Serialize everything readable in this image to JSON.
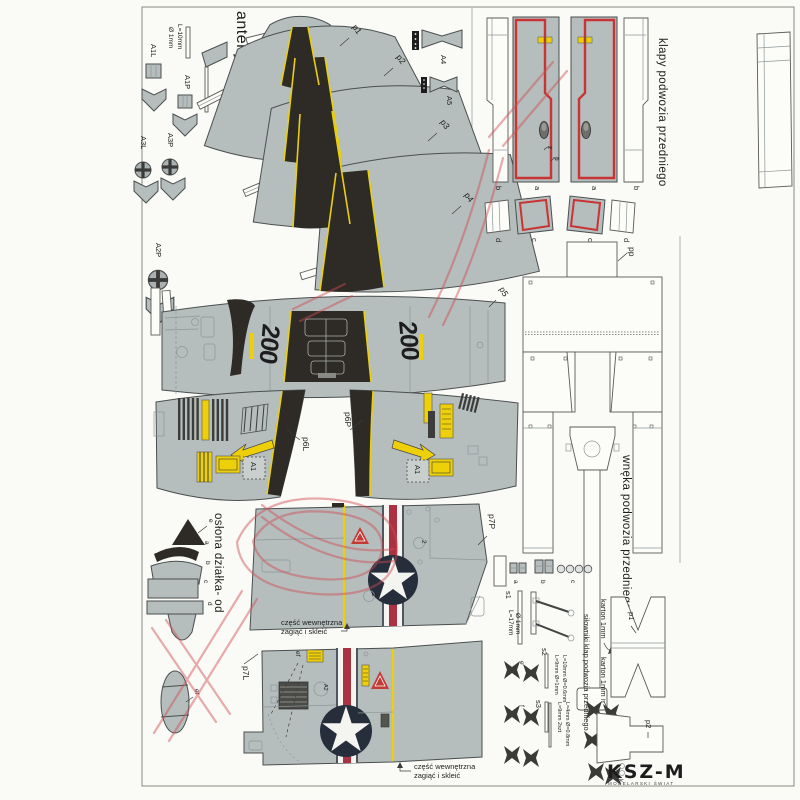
{
  "colors": {
    "part_gray": "#b5bdbd",
    "panel_black": "#2e2a26",
    "accent_yellow": "#edd009",
    "outline_red": "#c93434",
    "insignia_navy": "#262e3c",
    "insignia_red": "#ab3243",
    "watermark_red": "#d04b50"
  },
  "anteny": {
    "title": "anteny",
    "wire_length": "L=10mm",
    "wire_diameter": "Ø 1mm",
    "a1l": "A1L",
    "a1p": "A1P",
    "a3l": "A3L",
    "a3p": "A3P",
    "a2p": "A2P"
  },
  "nose": {
    "p1": "p1",
    "p2": "p2",
    "p3": "p3",
    "p4": "p4",
    "p5": "p5",
    "a4": "A4",
    "a5": "A5",
    "number": "200",
    "p6l": "p6L",
    "p6p": "p6P",
    "rescue_placard": "A1"
  },
  "gear_doors": {
    "title": "klapy podwozia przedniego",
    "a": "a",
    "b": "b",
    "c": "c",
    "d": "d",
    "z": "z",
    "p": "p"
  },
  "gear_bay": {
    "title": "wnęka podwozia przedniego",
    "pp": "pp"
  },
  "gun_cover": {
    "title": "osłona działka- od",
    "a": "a",
    "b": "b",
    "c": "c",
    "d": "d",
    "e": "e",
    "ef": "ef"
  },
  "fuselage": {
    "p7p": "p7P",
    "p7l": "p7L",
    "circled_2": "2",
    "circled_a2": "A2",
    "ef": "ef",
    "fold_note_1": "część wewnętrzna",
    "fold_note_2": "zagiąć i skleić"
  },
  "actuators": {
    "title": "siłowniki klap podwozia przedniego",
    "a": "a",
    "b": "b",
    "c": "c",
    "s1": "s1",
    "s1_len": "L=17mm",
    "s1_dia": "Ø 1mm",
    "s2": "s2",
    "s2_note1": "L=9mm Ø=1mm",
    "s2_note2": "L=10mm Ø=0.6mm",
    "s3": "s3",
    "s3_note1": "L=9mm 2szt",
    "s3_note2": "L=4mm Ø=0.8mm",
    "e": "e",
    "f": "f",
    "g": "g",
    "h": "h",
    "k": "k"
  },
  "cardboard": {
    "note": "karton 1mm",
    "p1": "p1",
    "p2": "p2"
  },
  "publisher": {
    "brand": "KSZ-M",
    "tagline": "MODELARSKI ŚWIAT"
  }
}
